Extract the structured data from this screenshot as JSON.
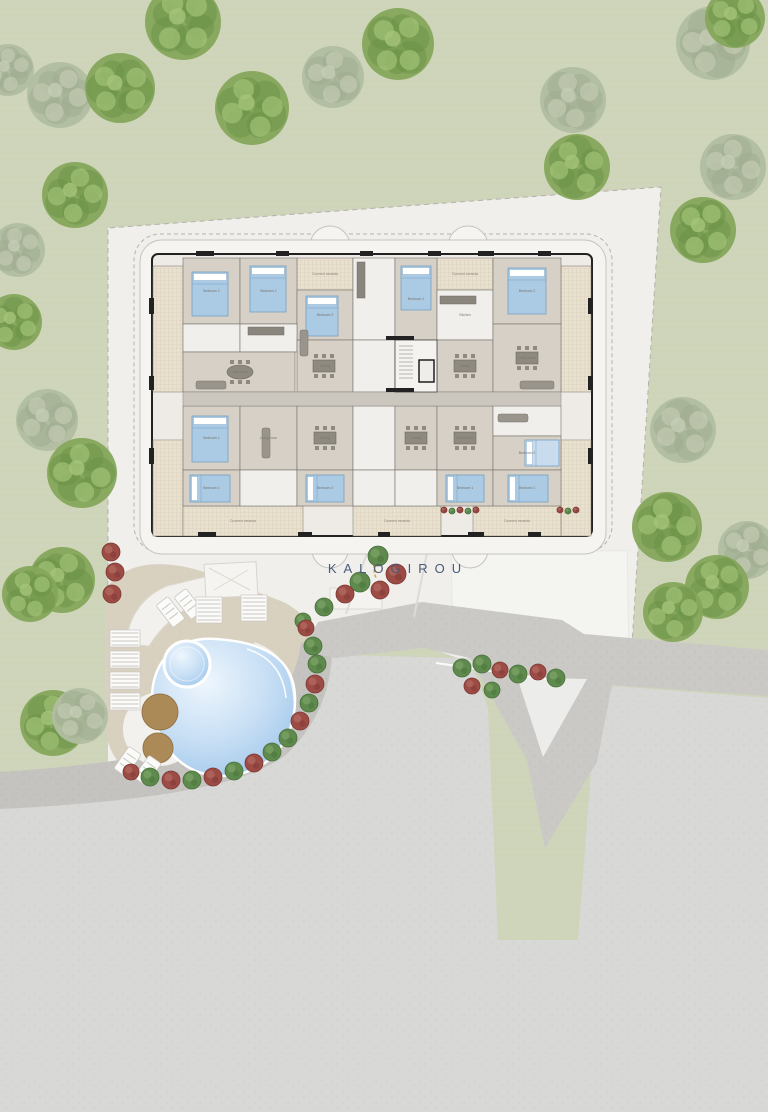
{
  "site": {
    "name": "KALOGIROU"
  },
  "colors": {
    "grass": "#cfd5ba",
    "parcel": "#f0efec",
    "flat_road": "#d8d8d6",
    "band_road": "#cac9c5",
    "curb": "#c4c3bf",
    "deck": "#d9d1c0",
    "pool_light": "#eaf4fc",
    "pool_mid": "#c6def4",
    "pool_dark": "#9dc5ea",
    "wood": "#b5915e",
    "room": "#d7d0c6",
    "room_white": "#f1efec",
    "veranda": "#e9e1d0",
    "veranda_line": "#d2c7b0",
    "corridor": "#ccc7be",
    "wall": "#222222",
    "room_stroke": "#73706a",
    "bed": "#abcae4",
    "bed_stroke": "#76a0c2",
    "bed_pale": "#c8dcee",
    "furniture": "#8f8a80",
    "bush_green": "#5f8a4d",
    "bush_green_hi": "#7ba266",
    "bush_red": "#9c4b45",
    "bush_red_hi": "#b26a60",
    "tree_bright": "#85a75b",
    "tree_bright_dark": "#6a9145",
    "tree_bright_light": "#a5c47a",
    "tree_pale": "#b1bea1",
    "tree_pale_dark": "#9dac8d",
    "tree_pale_light": "#c4cdb5",
    "label": "#4a5a7a"
  },
  "trees": [
    {
      "x": 183,
      "y": 22,
      "r": 38,
      "v": "b"
    },
    {
      "x": 8,
      "y": 70,
      "r": 26,
      "v": "p"
    },
    {
      "x": 60,
      "y": 95,
      "r": 33,
      "v": "p"
    },
    {
      "x": 120,
      "y": 88,
      "r": 35,
      "v": "b"
    },
    {
      "x": 252,
      "y": 108,
      "r": 37,
      "v": "b"
    },
    {
      "x": 333,
      "y": 77,
      "r": 31,
      "v": "p"
    },
    {
      "x": 398,
      "y": 44,
      "r": 36,
      "v": "b"
    },
    {
      "x": 573,
      "y": 100,
      "r": 33,
      "v": "p"
    },
    {
      "x": 713,
      "y": 43,
      "r": 37,
      "v": "p"
    },
    {
      "x": 735,
      "y": 18,
      "r": 30,
      "v": "b"
    },
    {
      "x": 577,
      "y": 167,
      "r": 33,
      "v": "b"
    },
    {
      "x": 733,
      "y": 167,
      "r": 33,
      "v": "p"
    },
    {
      "x": 703,
      "y": 230,
      "r": 33,
      "v": "b"
    },
    {
      "x": 18,
      "y": 250,
      "r": 27,
      "v": "p"
    },
    {
      "x": 75,
      "y": 195,
      "r": 33,
      "v": "b"
    },
    {
      "x": 14,
      "y": 322,
      "r": 28,
      "v": "b"
    },
    {
      "x": 47,
      "y": 420,
      "r": 31,
      "v": "p"
    },
    {
      "x": 82,
      "y": 473,
      "r": 35,
      "v": "b"
    },
    {
      "x": 62,
      "y": 580,
      "r": 33,
      "v": "b"
    },
    {
      "x": 30,
      "y": 594,
      "r": 28,
      "v": "b"
    },
    {
      "x": 53,
      "y": 723,
      "r": 33,
      "v": "b"
    },
    {
      "x": 80,
      "y": 716,
      "r": 28,
      "v": "p"
    },
    {
      "x": 683,
      "y": 430,
      "r": 33,
      "v": "p"
    },
    {
      "x": 667,
      "y": 527,
      "r": 35,
      "v": "b"
    },
    {
      "x": 747,
      "y": 550,
      "r": 29,
      "v": "p"
    },
    {
      "x": 717,
      "y": 587,
      "r": 32,
      "v": "b"
    },
    {
      "x": 673,
      "y": 612,
      "r": 30,
      "v": "b"
    }
  ],
  "bushes": [
    {
      "x": 111,
      "y": 552,
      "r": 9,
      "c": "r"
    },
    {
      "x": 115,
      "y": 572,
      "r": 9,
      "c": "r"
    },
    {
      "x": 112,
      "y": 594,
      "r": 9,
      "c": "r"
    },
    {
      "x": 378,
      "y": 556,
      "r": 10,
      "c": "g"
    },
    {
      "x": 396,
      "y": 574,
      "r": 10,
      "c": "r"
    },
    {
      "x": 360,
      "y": 582,
      "r": 10,
      "c": "g"
    },
    {
      "x": 380,
      "y": 590,
      "r": 9,
      "c": "r"
    },
    {
      "x": 345,
      "y": 594,
      "r": 9,
      "c": "r"
    },
    {
      "x": 324,
      "y": 607,
      "r": 9,
      "c": "g"
    },
    {
      "x": 303,
      "y": 621,
      "r": 8,
      "c": "g"
    },
    {
      "x": 306,
      "y": 628,
      "r": 8,
      "c": "r"
    },
    {
      "x": 313,
      "y": 646,
      "r": 9,
      "c": "g"
    },
    {
      "x": 317,
      "y": 664,
      "r": 9,
      "c": "g"
    },
    {
      "x": 315,
      "y": 684,
      "r": 9,
      "c": "r"
    },
    {
      "x": 309,
      "y": 703,
      "r": 9,
      "c": "g"
    },
    {
      "x": 300,
      "y": 721,
      "r": 9,
      "c": "r"
    },
    {
      "x": 288,
      "y": 738,
      "r": 9,
      "c": "g"
    },
    {
      "x": 272,
      "y": 752,
      "r": 9,
      "c": "g"
    },
    {
      "x": 254,
      "y": 763,
      "r": 9,
      "c": "r"
    },
    {
      "x": 234,
      "y": 771,
      "r": 9,
      "c": "g"
    },
    {
      "x": 213,
      "y": 777,
      "r": 9,
      "c": "r"
    },
    {
      "x": 192,
      "y": 780,
      "r": 9,
      "c": "g"
    },
    {
      "x": 171,
      "y": 780,
      "r": 9,
      "c": "r"
    },
    {
      "x": 150,
      "y": 777,
      "r": 9,
      "c": "g"
    },
    {
      "x": 131,
      "y": 772,
      "r": 8,
      "c": "r"
    },
    {
      "x": 462,
      "y": 668,
      "r": 9,
      "c": "g"
    },
    {
      "x": 482,
      "y": 664,
      "r": 9,
      "c": "g"
    },
    {
      "x": 500,
      "y": 670,
      "r": 8,
      "c": "r"
    },
    {
      "x": 518,
      "y": 674,
      "r": 9,
      "c": "g"
    },
    {
      "x": 538,
      "y": 672,
      "r": 8,
      "c": "r"
    },
    {
      "x": 556,
      "y": 678,
      "r": 9,
      "c": "g"
    },
    {
      "x": 472,
      "y": 686,
      "r": 8,
      "c": "r"
    },
    {
      "x": 492,
      "y": 690,
      "r": 8,
      "c": "g"
    },
    {
      "x": 444,
      "y": 510,
      "r": 3,
      "c": "r"
    },
    {
      "x": 452,
      "y": 511,
      "r": 3,
      "c": "g"
    },
    {
      "x": 460,
      "y": 510,
      "r": 3,
      "c": "r"
    },
    {
      "x": 468,
      "y": 511,
      "r": 3,
      "c": "g"
    },
    {
      "x": 476,
      "y": 510,
      "r": 3,
      "c": "r"
    },
    {
      "x": 560,
      "y": 510,
      "r": 3,
      "c": "r"
    },
    {
      "x": 568,
      "y": 511,
      "r": 3,
      "c": "g"
    },
    {
      "x": 576,
      "y": 510,
      "r": 3,
      "c": "r"
    }
  ],
  "building": {
    "verandas": [
      {
        "x": 153,
        "y": 266,
        "w": 30,
        "h": 126,
        "label": ""
      },
      {
        "x": 153,
        "y": 440,
        "w": 30,
        "h": 96,
        "label": ""
      },
      {
        "x": 561,
        "y": 266,
        "w": 30,
        "h": 126,
        "label": ""
      },
      {
        "x": 561,
        "y": 440,
        "w": 30,
        "h": 96,
        "label": ""
      },
      {
        "x": 297,
        "y": 258,
        "w": 56,
        "h": 32,
        "label": "Covered veranda"
      },
      {
        "x": 437,
        "y": 258,
        "w": 56,
        "h": 32,
        "label": "Covered veranda"
      },
      {
        "x": 183,
        "y": 506,
        "w": 120,
        "h": 30,
        "label": "Covered veranda"
      },
      {
        "x": 353,
        "y": 506,
        "w": 88,
        "h": 30,
        "label": "Covered veranda"
      },
      {
        "x": 473,
        "y": 506,
        "w": 88,
        "h": 30,
        "label": "Covered veranda"
      }
    ],
    "rooms": [
      {
        "x": 183,
        "y": 258,
        "w": 57,
        "h": 66,
        "t": "room",
        "label": "Bedroom 2"
      },
      {
        "x": 240,
        "y": 258,
        "w": 57,
        "h": 66,
        "t": "room",
        "label": "Bedroom 1"
      },
      {
        "x": 297,
        "y": 290,
        "w": 56,
        "h": 50,
        "t": "room",
        "label": "Bedroom 3"
      },
      {
        "x": 353,
        "y": 258,
        "w": 42,
        "h": 82,
        "t": "white",
        "label": ""
      },
      {
        "x": 395,
        "y": 258,
        "w": 42,
        "h": 82,
        "t": "room",
        "label": "Bedroom 1"
      },
      {
        "x": 437,
        "y": 290,
        "w": 56,
        "h": 50,
        "t": "white",
        "label": "Kitchen"
      },
      {
        "x": 493,
        "y": 258,
        "w": 68,
        "h": 66,
        "t": "room",
        "label": "Bedroom 2"
      },
      {
        "x": 183,
        "y": 324,
        "w": 57,
        "h": 28,
        "t": "white",
        "label": ""
      },
      {
        "x": 240,
        "y": 324,
        "w": 57,
        "h": 28,
        "t": "white",
        "label": ""
      },
      {
        "x": 183,
        "y": 352,
        "w": 112,
        "h": 40,
        "t": "room",
        "label": "Living room"
      },
      {
        "x": 297,
        "y": 340,
        "w": 56,
        "h": 52,
        "t": "room",
        "label": "Dining"
      },
      {
        "x": 353,
        "y": 340,
        "w": 42,
        "h": 52,
        "t": "white",
        "label": ""
      },
      {
        "x": 437,
        "y": 340,
        "w": 56,
        "h": 52,
        "t": "room",
        "label": "Dining"
      },
      {
        "x": 493,
        "y": 324,
        "w": 68,
        "h": 68,
        "t": "room",
        "label": "Living room"
      },
      {
        "x": 183,
        "y": 406,
        "w": 57,
        "h": 64,
        "t": "room",
        "label": "Bedroom 1"
      },
      {
        "x": 240,
        "y": 406,
        "w": 57,
        "h": 64,
        "t": "room",
        "label": "Living room"
      },
      {
        "x": 297,
        "y": 406,
        "w": 56,
        "h": 64,
        "t": "room",
        "label": "Dining"
      },
      {
        "x": 353,
        "y": 406,
        "w": 42,
        "h": 64,
        "t": "white",
        "label": ""
      },
      {
        "x": 395,
        "y": 406,
        "w": 42,
        "h": 64,
        "t": "room",
        "label": "Dining"
      },
      {
        "x": 437,
        "y": 406,
        "w": 56,
        "h": 64,
        "t": "room",
        "label": "Living room"
      },
      {
        "x": 493,
        "y": 406,
        "w": 68,
        "h": 30,
        "t": "white",
        "label": ""
      },
      {
        "x": 493,
        "y": 436,
        "w": 68,
        "h": 34,
        "t": "room",
        "label": "Bedroom 2"
      },
      {
        "x": 183,
        "y": 470,
        "w": 57,
        "h": 36,
        "t": "room",
        "label": "Bedroom 1"
      },
      {
        "x": 240,
        "y": 470,
        "w": 57,
        "h": 36,
        "t": "white",
        "label": ""
      },
      {
        "x": 297,
        "y": 470,
        "w": 56,
        "h": 36,
        "t": "room",
        "label": "Bedroom 3"
      },
      {
        "x": 353,
        "y": 470,
        "w": 42,
        "h": 36,
        "t": "white",
        "label": ""
      },
      {
        "x": 395,
        "y": 470,
        "w": 42,
        "h": 36,
        "t": "white",
        "label": ""
      },
      {
        "x": 437,
        "y": 470,
        "w": 56,
        "h": 36,
        "t": "room",
        "label": "Bedroom 1"
      },
      {
        "x": 493,
        "y": 470,
        "w": 68,
        "h": 36,
        "t": "room",
        "label": "Bedroom 1"
      }
    ],
    "beds": [
      {
        "x": 192,
        "y": 272,
        "w": 36,
        "h": 44
      },
      {
        "x": 250,
        "y": 266,
        "w": 36,
        "h": 46
      },
      {
        "x": 306,
        "y": 296,
        "w": 32,
        "h": 40
      },
      {
        "x": 401,
        "y": 266,
        "w": 30,
        "h": 44
      },
      {
        "x": 508,
        "y": 268,
        "w": 38,
        "h": 46
      },
      {
        "x": 192,
        "y": 416,
        "w": 36,
        "h": 46
      },
      {
        "x": 525,
        "y": 440,
        "w": 34,
        "h": 26,
        "pale": true,
        "horiz": true
      },
      {
        "x": 190,
        "y": 475,
        "w": 40,
        "h": 27,
        "horiz": true
      },
      {
        "x": 306,
        "y": 475,
        "w": 38,
        "h": 27,
        "horiz": true
      },
      {
        "x": 446,
        "y": 475,
        "w": 38,
        "h": 27,
        "horiz": true
      },
      {
        "x": 508,
        "y": 475,
        "w": 40,
        "h": 27,
        "horiz": true
      }
    ],
    "tables": [
      {
        "x": 240,
        "y": 372,
        "oval": true
      },
      {
        "x": 324,
        "y": 366
      },
      {
        "x": 465,
        "y": 366
      },
      {
        "x": 527,
        "y": 358
      },
      {
        "x": 325,
        "y": 438
      },
      {
        "x": 416,
        "y": 438
      },
      {
        "x": 465,
        "y": 438
      }
    ],
    "sofas": [
      {
        "x": 196,
        "y": 381,
        "w": 30,
        "h": 8
      },
      {
        "x": 300,
        "y": 330,
        "w": 8,
        "h": 26
      },
      {
        "x": 520,
        "y": 381,
        "w": 34,
        "h": 8
      },
      {
        "x": 262,
        "y": 428,
        "w": 8,
        "h": 30
      },
      {
        "x": 498,
        "y": 414,
        "w": 30,
        "h": 8
      }
    ],
    "kitchens": [
      {
        "x": 357,
        "y": 262,
        "w": 8,
        "h": 36
      },
      {
        "x": 440,
        "y": 296,
        "w": 36,
        "h": 8
      },
      {
        "x": 248,
        "y": 327,
        "w": 36,
        "h": 8
      }
    ],
    "wall_bars": [
      {
        "x": 196,
        "y": 251,
        "w": 18,
        "h": 5
      },
      {
        "x": 276,
        "y": 251,
        "w": 13,
        "h": 5
      },
      {
        "x": 360,
        "y": 251,
        "w": 13,
        "h": 5
      },
      {
        "x": 428,
        "y": 251,
        "w": 13,
        "h": 5
      },
      {
        "x": 478,
        "y": 251,
        "w": 16,
        "h": 5
      },
      {
        "x": 538,
        "y": 251,
        "w": 13,
        "h": 5
      },
      {
        "x": 198,
        "y": 532,
        "w": 18,
        "h": 5
      },
      {
        "x": 298,
        "y": 532,
        "w": 14,
        "h": 5
      },
      {
        "x": 378,
        "y": 532,
        "w": 12,
        "h": 5
      },
      {
        "x": 468,
        "y": 532,
        "w": 16,
        "h": 5
      },
      {
        "x": 528,
        "y": 532,
        "w": 13,
        "h": 5
      },
      {
        "x": 149,
        "y": 298,
        "w": 5,
        "h": 16
      },
      {
        "x": 149,
        "y": 376,
        "w": 5,
        "h": 14
      },
      {
        "x": 149,
        "y": 448,
        "w": 5,
        "h": 16
      },
      {
        "x": 588,
        "y": 298,
        "w": 5,
        "h": 16
      },
      {
        "x": 588,
        "y": 376,
        "w": 5,
        "h": 14
      },
      {
        "x": 588,
        "y": 448,
        "w": 5,
        "h": 16
      },
      {
        "x": 386,
        "y": 336,
        "w": 28,
        "h": 4
      },
      {
        "x": 386,
        "y": 388,
        "w": 28,
        "h": 4
      }
    ],
    "core": {
      "x": 395,
      "y": 340,
      "w": 42,
      "h": 52
    }
  },
  "pool": {
    "spa": {
      "x": 187,
      "y": 664,
      "r": 23
    },
    "wood_circles": [
      {
        "x": 160,
        "y": 712,
        "r": 18
      },
      {
        "x": 158,
        "y": 748,
        "r": 15
      }
    ]
  },
  "loungers": [
    {
      "x": 163,
      "y": 598,
      "w": 15,
      "h": 28,
      "rot": -38,
      "type": "single"
    },
    {
      "x": 181,
      "y": 590,
      "w": 15,
      "h": 28,
      "rot": -38,
      "type": "single"
    },
    {
      "x": 196,
      "y": 597,
      "w": 26,
      "h": 26,
      "rot": 0,
      "type": "stack"
    },
    {
      "x": 241,
      "y": 595,
      "w": 26,
      "h": 26,
      "rot": 0,
      "type": "stack"
    },
    {
      "x": 110,
      "y": 630,
      "w": 30,
      "h": 17,
      "rot": 0,
      "type": "stack"
    },
    {
      "x": 110,
      "y": 651,
      "w": 30,
      "h": 17,
      "rot": 0,
      "type": "stack"
    },
    {
      "x": 110,
      "y": 672,
      "w": 30,
      "h": 17,
      "rot": 0,
      "type": "stack"
    },
    {
      "x": 110,
      "y": 693,
      "w": 30,
      "h": 17,
      "rot": 0,
      "type": "stack"
    },
    {
      "x": 120,
      "y": 748,
      "w": 15,
      "h": 27,
      "rot": 35,
      "type": "single"
    },
    {
      "x": 140,
      "y": 757,
      "w": 15,
      "h": 27,
      "rot": 35,
      "type": "single"
    }
  ]
}
